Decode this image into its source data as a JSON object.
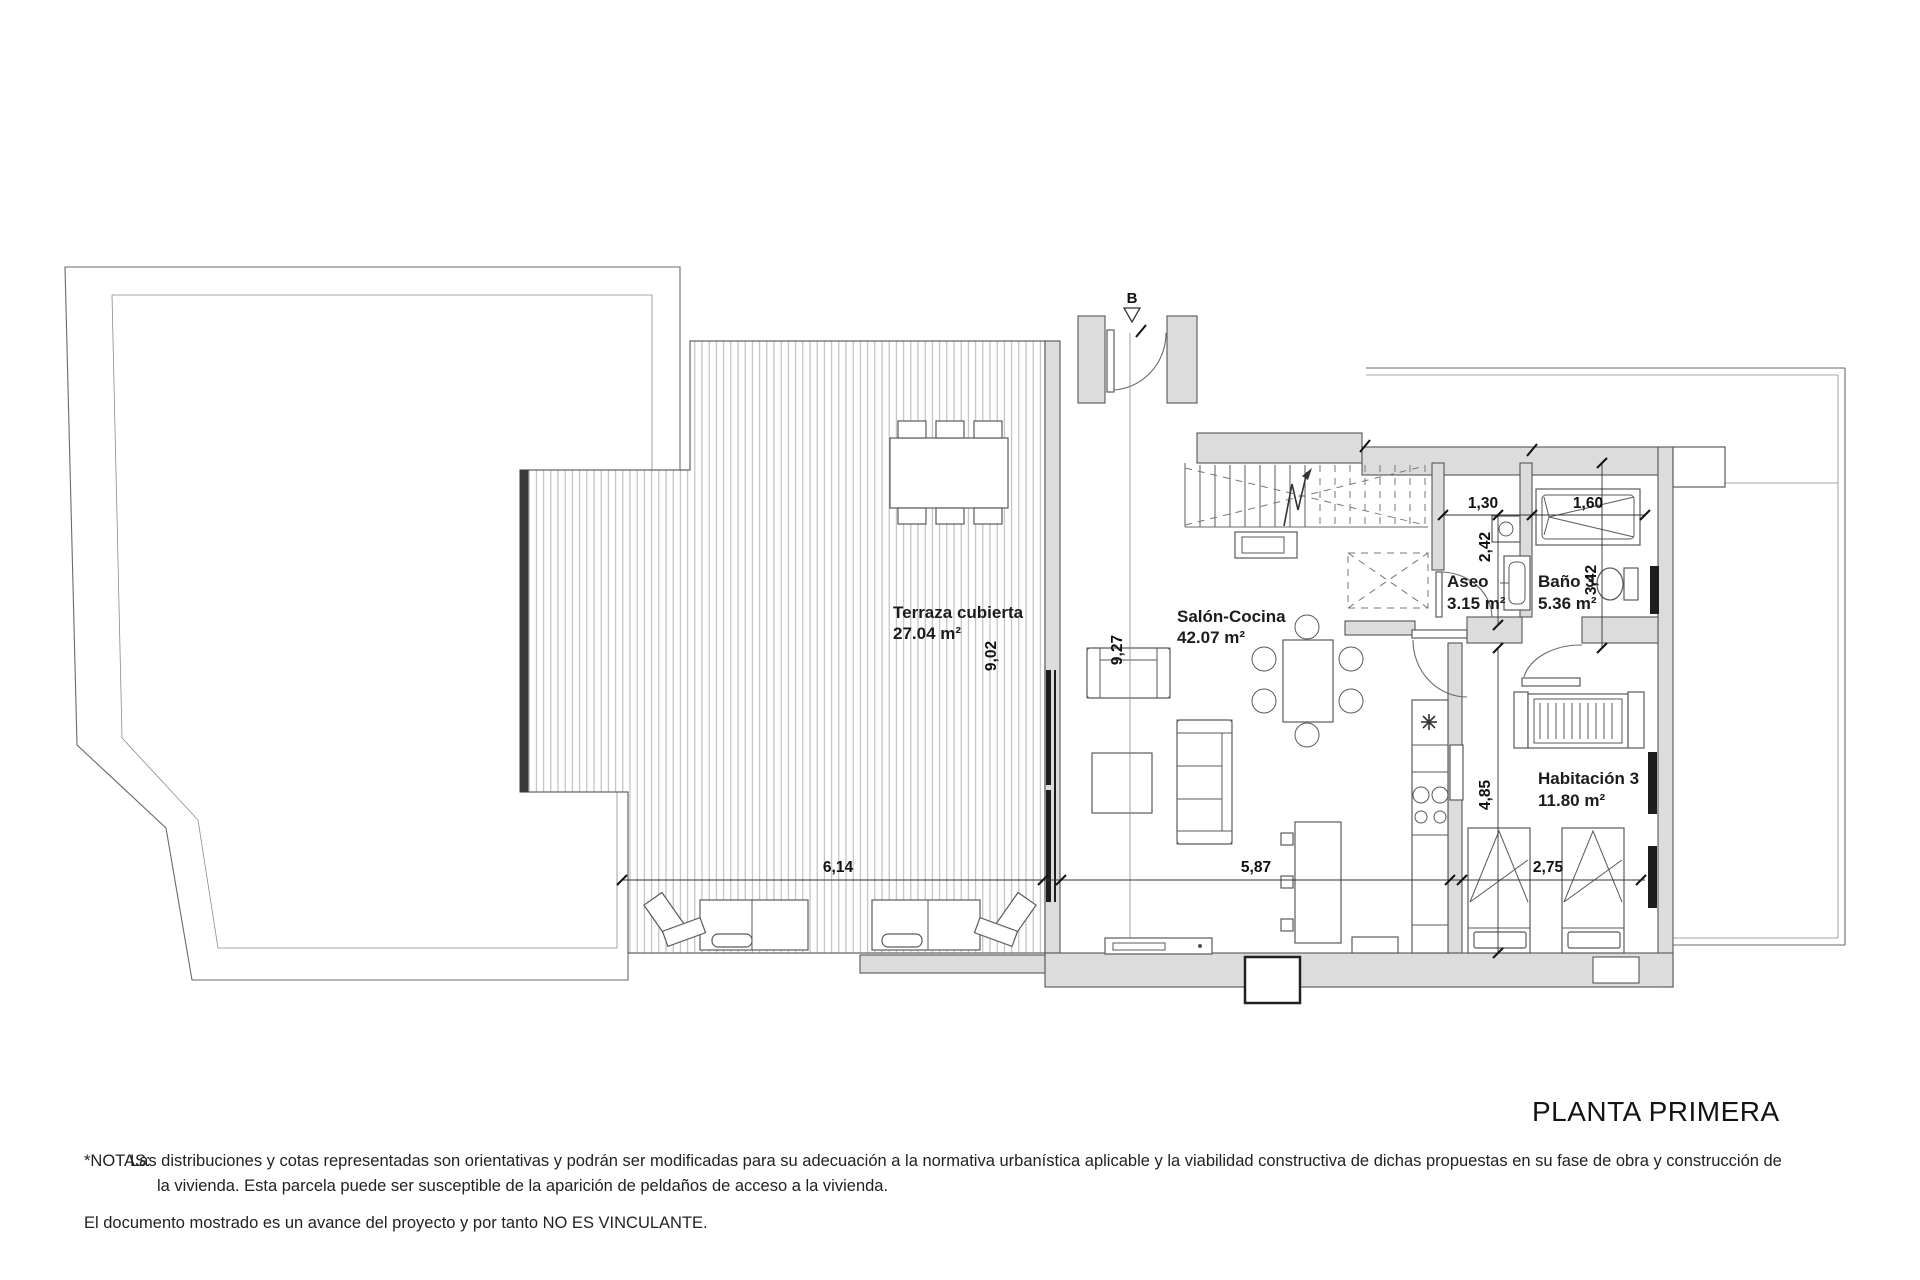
{
  "title_block": {
    "title": "PLANTA PRIMERA"
  },
  "notes": {
    "label": "*NOTAS:",
    "line1": "Las distribuciones y cotas representadas son orientativas y podrán ser modificadas para su adecuación a la normativa urbanística aplicable y la viabilidad constructiva de dichas propuestas en su fase de obra y construcción de",
    "line2": "la vivienda. Esta parcela puede ser susceptible de la aparición de peldaños de acceso a la vivienda.",
    "disclaimer": "El documento mostrado es un avance del proyecto y por tanto NO ES VINCULANTE."
  },
  "floorplan": {
    "section_marker": "B",
    "rooms": [
      {
        "name": "Terraza cubierta",
        "area": "27.04 m²"
      },
      {
        "name": "Salón-Cocina",
        "area": "42.07 m²"
      },
      {
        "name": "Aseo",
        "area": "3.15 m²"
      },
      {
        "name": "Baño 3",
        "area": "5.36 m²"
      },
      {
        "name": "Habitación 3",
        "area": "11.80 m²"
      }
    ],
    "dimensions": {
      "terraza_height": "9,02",
      "salon_section_height": "9,27",
      "terraza_width": "6,14",
      "salon_width": "5,87",
      "habitacion_width": "2,75",
      "habitacion_height": "4,85",
      "aseo_width": "1,30",
      "bano_width": "1,60",
      "aseo_height": "2,42",
      "bano_height": "3,42"
    },
    "colors": {
      "wall_fill": "#dcdcdc",
      "line": "#4a4a4a",
      "deck_stripe": "#b3b3b3"
    }
  }
}
